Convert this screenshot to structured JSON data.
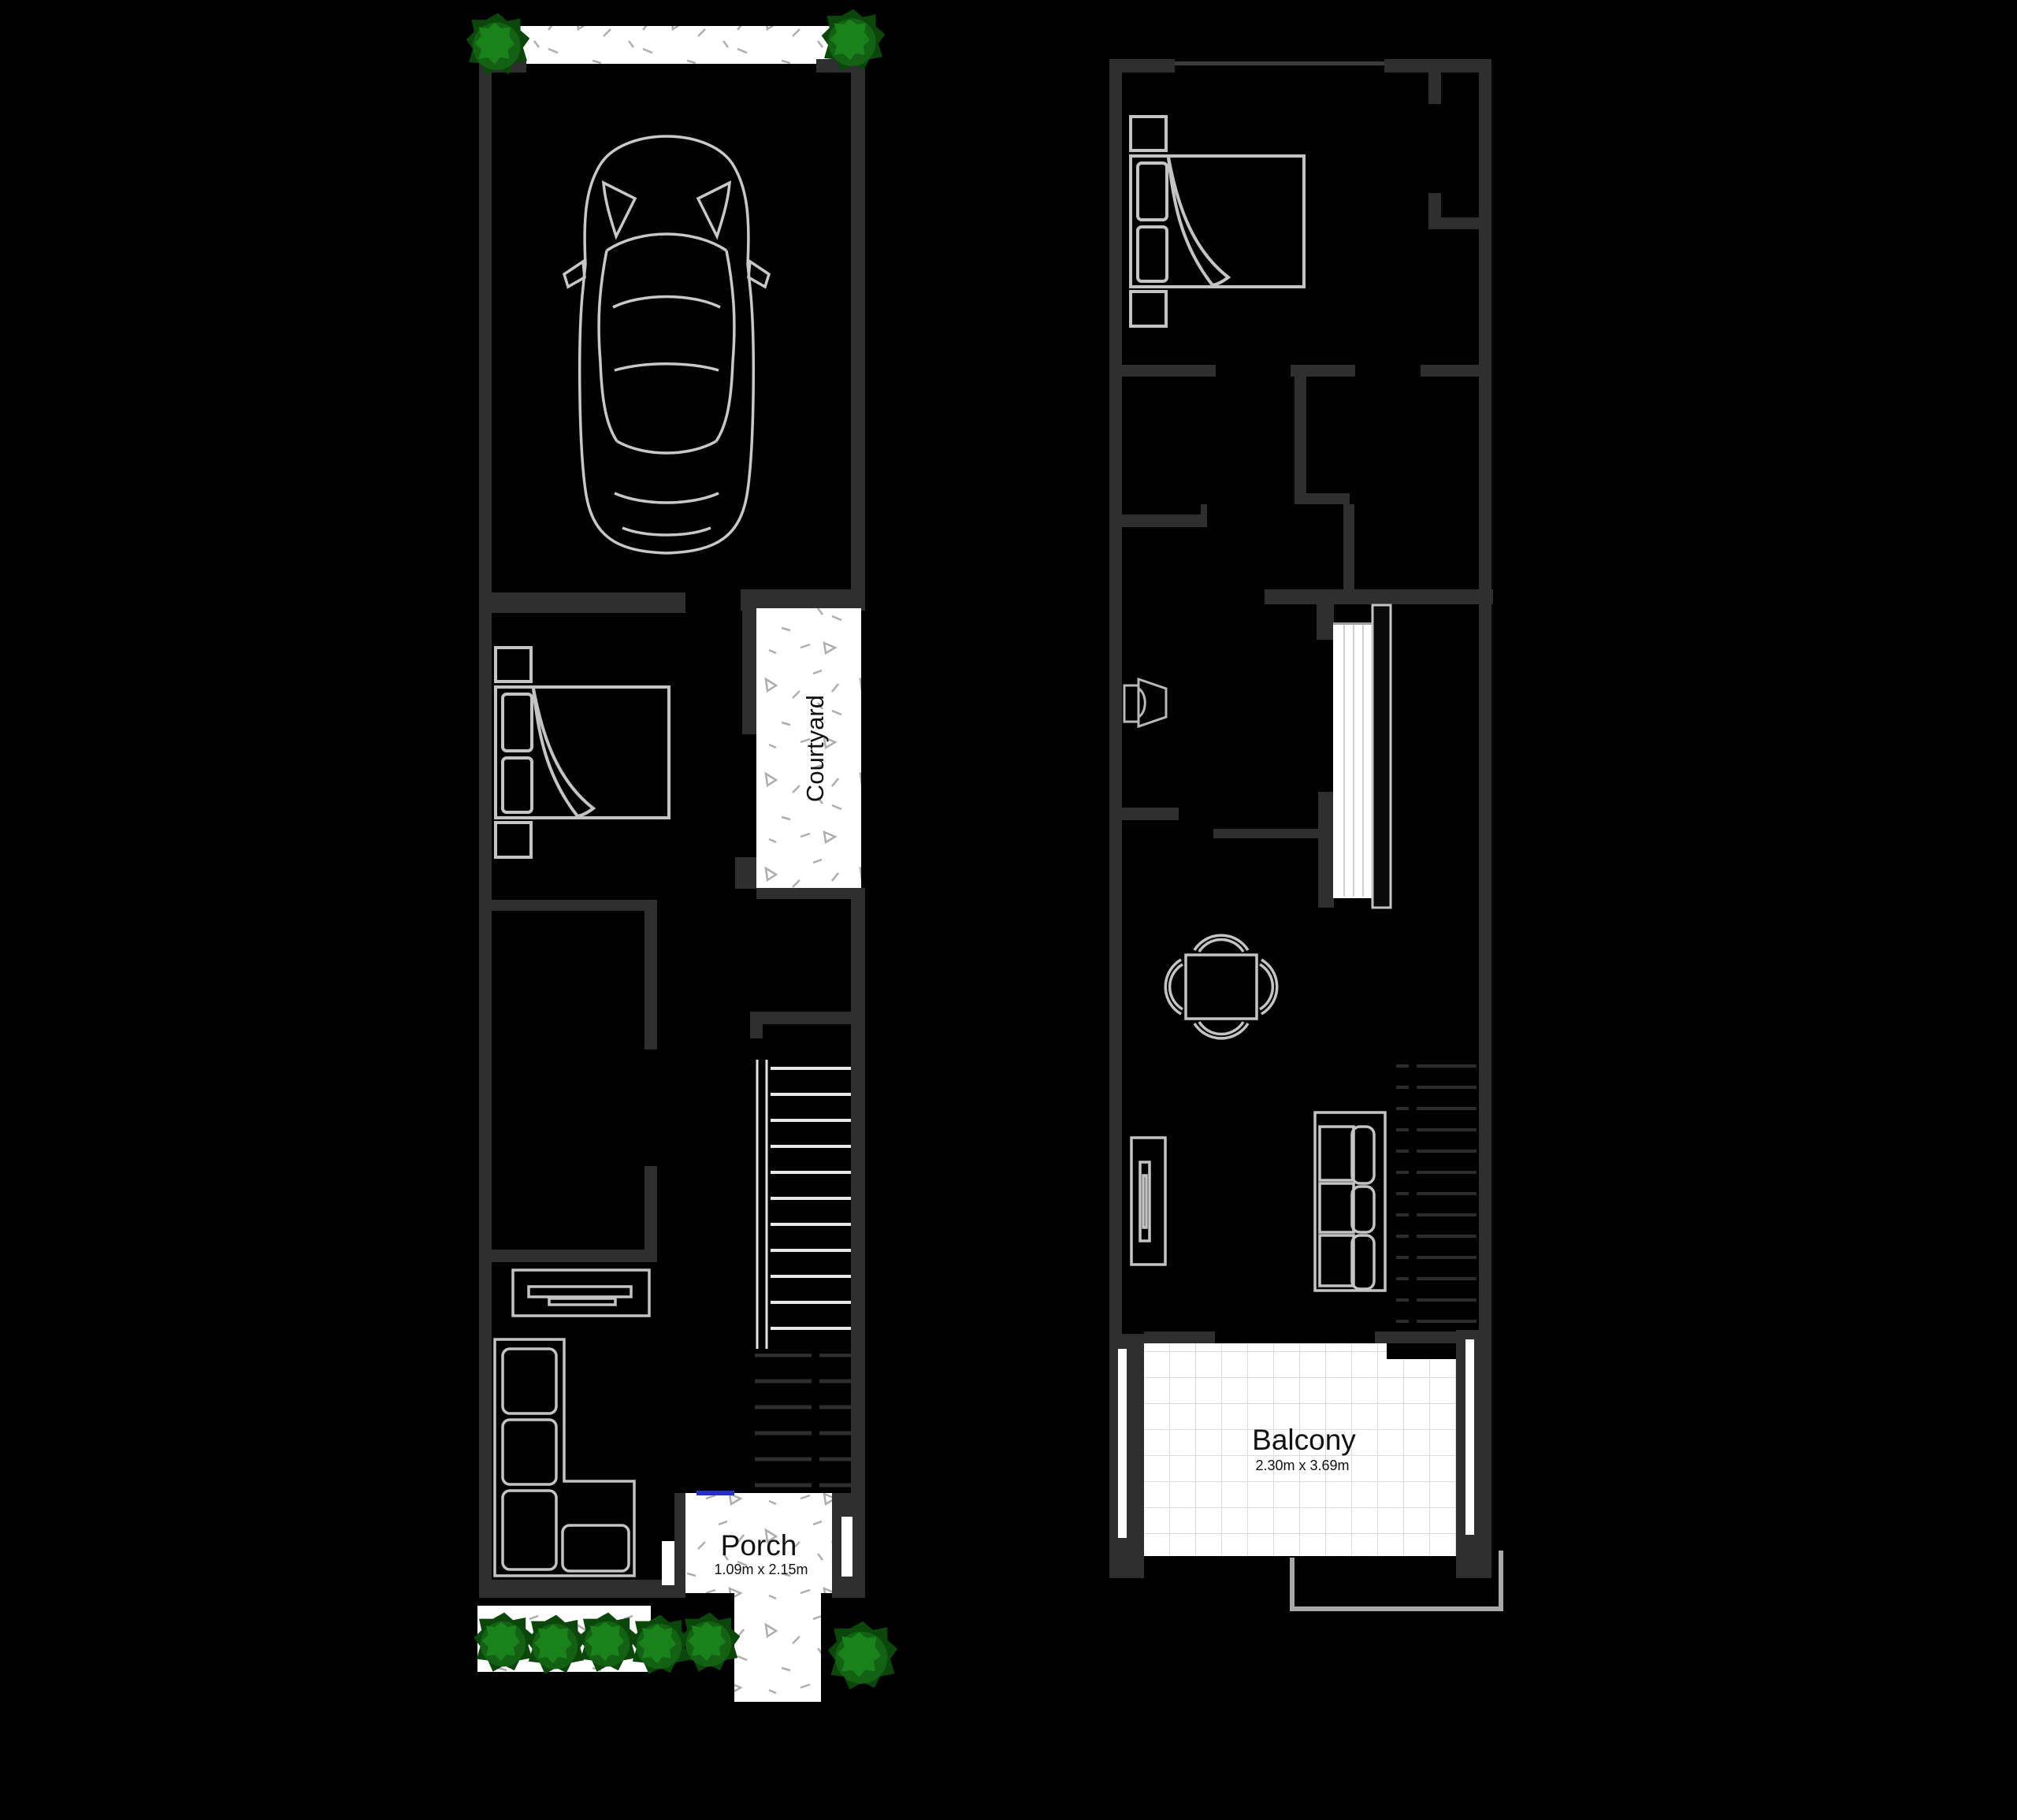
{
  "plan": {
    "type": "floor-plan",
    "floors": [
      {
        "id": "ground-floor",
        "rooms": [
          "garage",
          "bedroom",
          "courtyard",
          "bathroom",
          "living",
          "porch"
        ],
        "features": [
          "car",
          "double-bed",
          "tv-console",
          "l-sofa",
          "staircase-up",
          "driveway",
          "garden-bushes",
          "concrete-path"
        ]
      },
      {
        "id": "first-floor",
        "rooms": [
          "bedroom",
          "walk-in-robe",
          "bathroom",
          "wc",
          "living-dining",
          "balcony"
        ],
        "features": [
          "double-bed",
          "toilet",
          "staircase",
          "dining-table-4-chairs",
          "tv-console",
          "sofa",
          "stair-void",
          "roof-outline"
        ]
      }
    ],
    "colors": {
      "background": "#000000",
      "wall": "#2f2f2f",
      "furniture_line": "#c4c4c4",
      "paved_white": "#ffffff",
      "speckle": "#adadad",
      "tile_line": "#dcdcdc",
      "bush_dark": "#0b470b",
      "bush_mid": "#136113",
      "bush_light": "#1a821a",
      "door_marker_blue": "#2331c8",
      "roof_outline": "#a8a8a8"
    }
  },
  "labels": {
    "courtyard": "Courtyard",
    "porch": "Porch",
    "porch_dims": "1.09m x 2.15m",
    "balcony": "Balcony",
    "balcony_dims": "2.30m x 3.69m"
  }
}
